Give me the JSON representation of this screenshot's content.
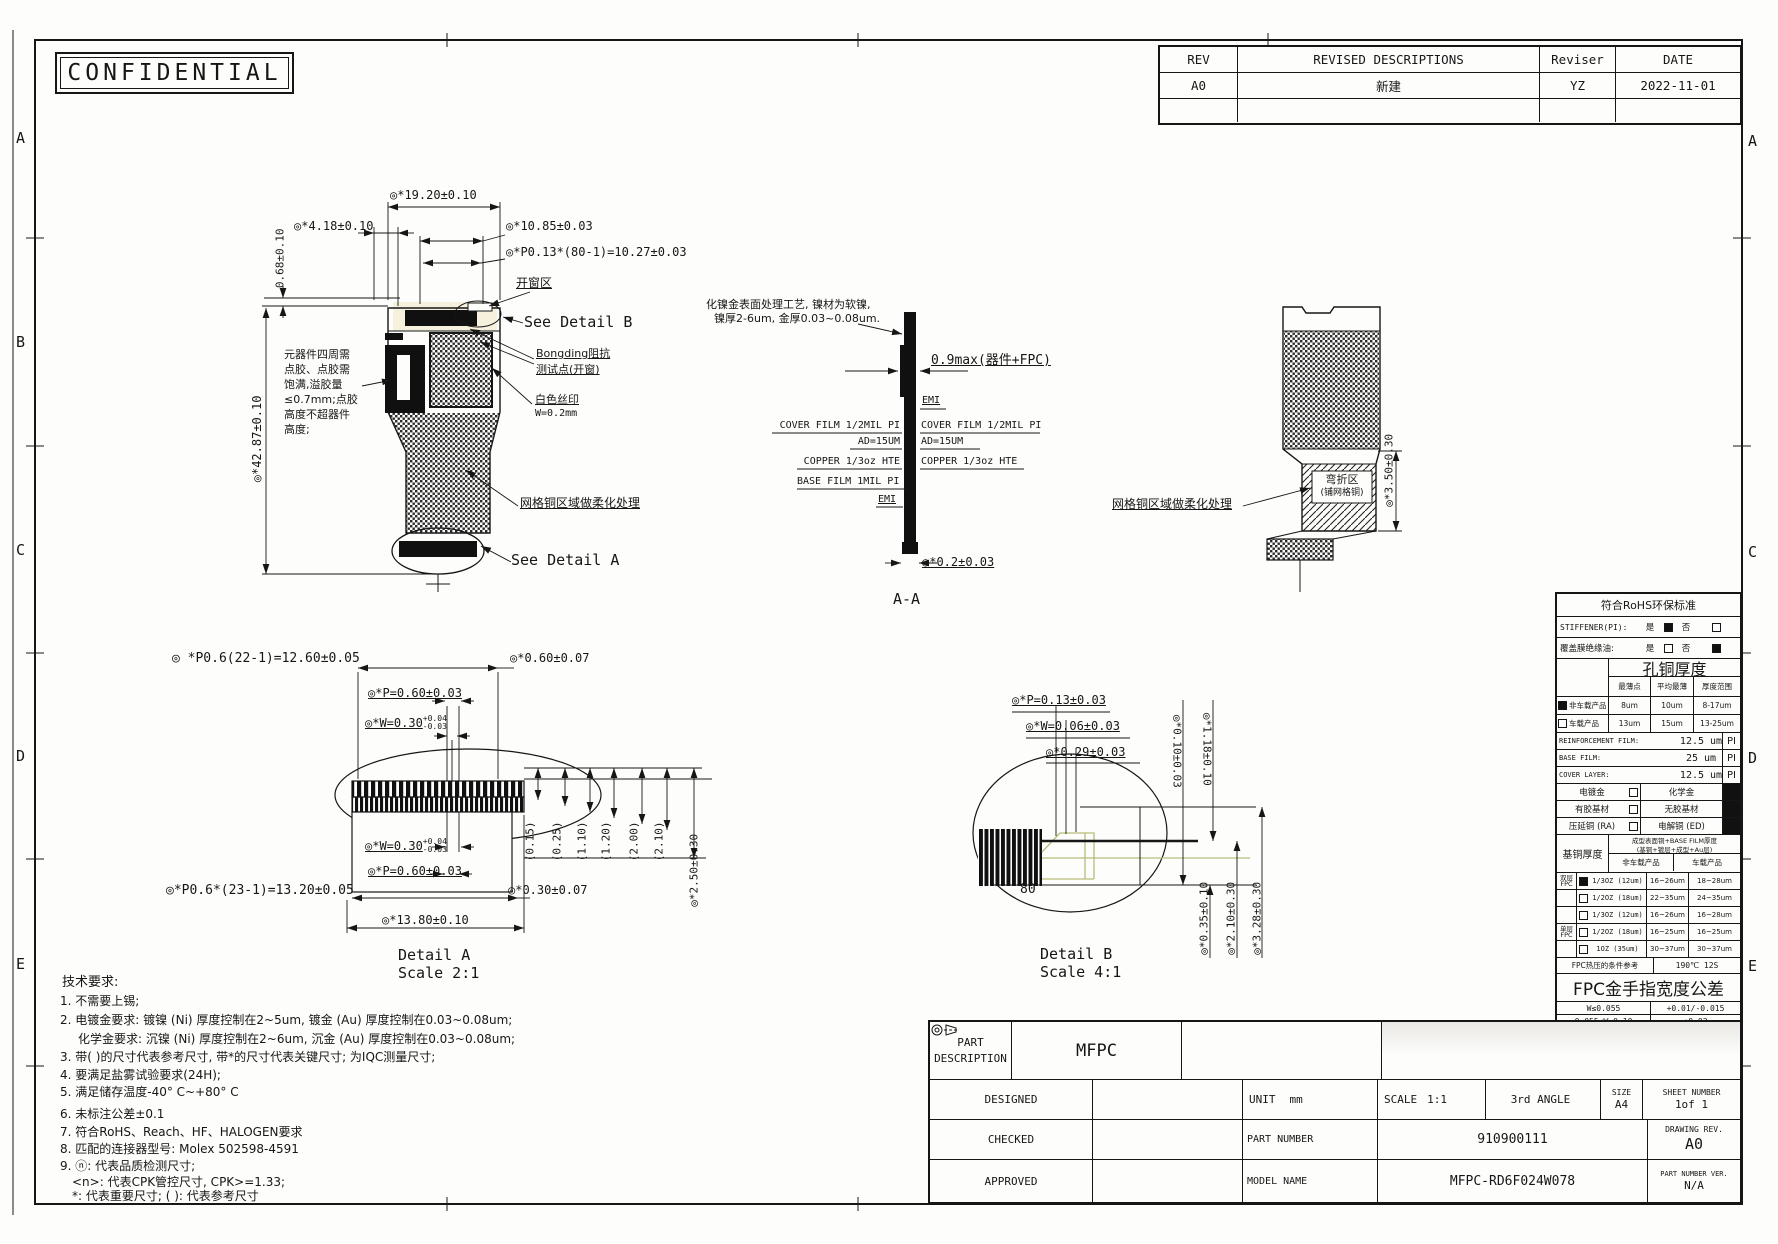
{
  "page": {
    "confidential": "CONFIDENTIAL"
  },
  "frame": {
    "left": [
      "A",
      "B",
      "C",
      "D",
      "E"
    ],
    "right": [
      "A",
      "C",
      "D",
      "E"
    ]
  },
  "rev_table": {
    "h": [
      "REV",
      "REVISED DESCRIPTIONS",
      "Reviser",
      "DATE"
    ],
    "r1": [
      "A0",
      "新建",
      "YZ",
      "2022-11-01"
    ]
  },
  "front": {
    "d_total_w": "◎*19.20±0.10",
    "d_left": "◎*4.18±0.10",
    "d_pad": "◎*10.85±0.03",
    "d_pitch": "◎*P0.13*(80-1)=10.27±0.03",
    "d_step": "0.68±0.10",
    "d_total_h": "◎*42.87±0.10",
    "window": "开窗区",
    "see_b": "See Detail B",
    "bonding1": "Bongding阻抗",
    "bonding2": "测试点(开窗)",
    "silk1": "白色丝印",
    "silk2": "W=0.2mm",
    "glue": [
      "元器件四周需",
      "点胶、点胶需",
      "饱满,溢胶量",
      "≤0.7mm;点胶",
      "高度不超器件",
      "高度;"
    ],
    "mesh": "网格铜区域做柔化处理",
    "see_a": "See Detail A"
  },
  "aa": {
    "note1": "化镍金表面处理工艺, 镍材为软镍,",
    "note2": "镍厚2-6um, 金厚0.03~0.08um.",
    "d_max": "0.9max(器件+FPC)",
    "emi_t": "EMI",
    "emi_b": "EMI",
    "cover_l": "COVER FILM 1/2MIL PI",
    "cover_r": "COVER FILM 1/2MIL PI",
    "ad_l": "AD=15UM",
    "ad_r": "AD=15UM",
    "cu_l": "COPPER 1/3oz HTE",
    "cu_r": "COPPER 1/3oz HTE",
    "base": "BASE FILM 1MIL PI",
    "d_thk": "◎*0.2±0.03",
    "title": "A-A"
  },
  "side": {
    "mesh": "网格铜区域做柔化处理",
    "bend1": "弯折区",
    "bend2": "(铺网格铜)",
    "d_h": "◎*3.50±0.30"
  },
  "da": {
    "d1": "◎ *P0.6(22-1)=12.60±0.05",
    "d2": "◎*0.60±0.07",
    "d3": "◎*P=0.60±0.03",
    "d4": "◎*W=0.30",
    "d4a": "+0.04",
    "d4b": "-0.03",
    "d5": "◎*W=0.30",
    "d5a": "+0.04",
    "d5b": "-0.03",
    "d6": "◎*P=0.60±0.03",
    "d7": "◎*P0.6*(23-1)=13.20±0.05",
    "d8": "◎*0.30±0.07",
    "d9": "◎*13.80±0.10",
    "refs": [
      "(0.15)",
      "(0.25)",
      "(1.10)",
      "(1.20)",
      "(2.00)",
      "(2.10)"
    ],
    "d10": "◎*2.50±0.30",
    "title": "Detail A",
    "scale": "Scale 2:1"
  },
  "db": {
    "d1": "◎*P=0.13±0.03",
    "d2": "◎*W=0.06±0.03",
    "d3": "◎*0.29±0.03",
    "dv1": "◎*0.10±0.03",
    "dv2": "◎*1.18±0.10",
    "pin": "80",
    "db1": "◎*0.35±0.10",
    "db2": "◎*2.10±0.30",
    "db3": "◎*3.28±0.30",
    "title": "Detail B",
    "scale": "Scale 4:1"
  },
  "rohs": {
    "title": "符合RoHS环保标准",
    "yes": "是",
    "no": "否",
    "stiffener": "STIFFENER(PI):",
    "stiffener_yes": true,
    "stiffener_no": false,
    "coverfilm": "覆盖膜绝缘油:",
    "coverfilm_yes": false,
    "coverfilm_no": true,
    "hole_title": "孔铜厚度",
    "hole_cols": [
      "最薄点",
      "平均最薄",
      "厚度范围"
    ],
    "hole_rows": [
      {
        "name": "非车载产品",
        "checked": true,
        "min": "8um",
        "avg": "10um",
        "range": "8-17um"
      },
      {
        "name": "车载产品",
        "checked": false,
        "min": "13um",
        "avg": "15um",
        "range": "13-25um"
      }
    ],
    "films": [
      {
        "label": "REINFORCEMENT FILM:",
        "value": "12.5 um",
        "mat": "PI"
      },
      {
        "label": "BASE FILM:",
        "value": "25 um",
        "mat": "PI"
      },
      {
        "label": "COVER LAYER:",
        "value": "12.5 um",
        "mat": "PI"
      }
    ],
    "opts": [
      {
        "l": "电镀金",
        "lc": false,
        "r": "化学金",
        "rc": true
      },
      {
        "l": "有胶基材",
        "lc": false,
        "r": "无胶基材",
        "rc": true
      },
      {
        "l": "压延铜 (RA)",
        "lc": false,
        "r": "电解铜 (ED)",
        "rc": true
      }
    ],
    "base_title": "基铜厚度",
    "base_h1": "成型表面铜+BASE FILM厚度",
    "base_h2": "(基铜+镀层+成型+Au层)",
    "base_cols": [
      "非车载产品",
      "车载产品"
    ],
    "cu_rows": [
      {
        "g": "双层FPC",
        "checked": true,
        "spec": "1/3OZ (12um)",
        "na": "16~26um",
        "au": "18~28um"
      },
      {
        "g": "",
        "checked": false,
        "spec": "1/2OZ (18um)",
        "na": "22~35um",
        "au": "24~35um"
      },
      {
        "g": "",
        "checked": false,
        "spec": "1/3OZ (12um)",
        "na": "16~26um",
        "au": "16~28um"
      },
      {
        "g": "单层FPC",
        "checked": false,
        "spec": "1/2OZ (18um)",
        "na": "16~25um",
        "au": "16~25um"
      },
      {
        "g": "",
        "checked": false,
        "spec": "1OZ (35um)",
        "na": "30~37um",
        "au": "30~37um"
      }
    ],
    "hot_label": "FPC热压的条件参考",
    "hot_value": "190℃ 12S",
    "finger_title": "FPC金手指宽度公差",
    "finger_rows": [
      {
        "c": "W≤0.055",
        "t": "+0.01/-0.015"
      },
      {
        "c": "0.055<W≤0.10",
        "t": "±0.02"
      },
      {
        "c": "0.10<W≤0.20",
        "t": "±0.03"
      },
      {
        "c": "W>0.2",
        "t": "±20%W"
      }
    ]
  },
  "notes": {
    "title": "技术要求:",
    "lines": [
      "1. 不需要上锡;",
      "2. 电镀金要求: 镀镍 (Ni) 厚度控制在2~5um, 镀金 (Au) 厚度控制在0.03~0.08um;",
      "化学金要求: 沉镍 (Ni) 厚度控制在2~6um, 沉金 (Au) 厚度控制在0.03~0.08um;",
      "3. 带( )的尺寸代表参考尺寸, 带*的尺寸代表关键尺寸;  为IQC测量尺寸;",
      "4. 要满足盐雾试验要求(24H);",
      "5. 满足储存温度-40° C~+80° C",
      "6. 未标注公差±0.1",
      "7. 符合RoHS、Reach、HF、HALOGEN要求",
      "8. 匹配的连接器型号: Molex 502598-4591",
      "9. ⓝ: 代表品质检测尺寸;",
      "<n>: 代表CPK管控尺寸, CPK>=1.33;",
      "*: 代表重要尺寸;  ( ): 代表参考尺寸"
    ]
  },
  "tb": {
    "part_desc": "PART DESCRIPTION",
    "part_desc_v": "MFPC",
    "designed": "DESIGNED",
    "checked": "CHECKED",
    "approved": "APPROVED",
    "unit": "UNIT",
    "unit_v": "mm",
    "scale": "SCALE",
    "scale_v": "1:1",
    "angle": "3rd ANGLE",
    "size": "SIZE",
    "size_v": "A4",
    "sheet": "SHEET NUMBER",
    "sheet_v": "1of 1",
    "pn": "PART NUMBER",
    "pn_v": "910900111",
    "rev": "DRAWING REV.",
    "rev_v": "A0",
    "model": "MODEL NAME",
    "model_v": "MFPC-RD6F024W078",
    "pnv": "PART NUMBER VER.",
    "pnv_v": "N/A"
  }
}
